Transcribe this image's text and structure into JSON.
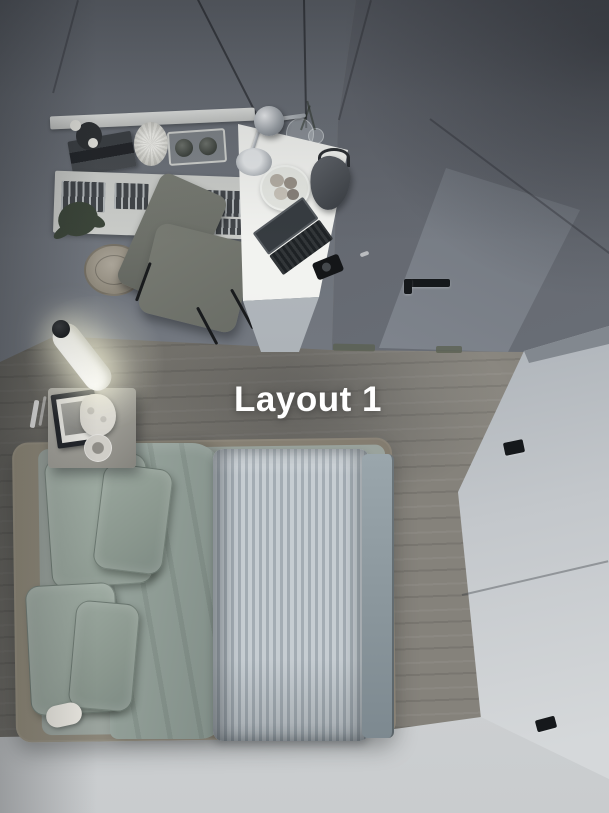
{
  "overlay": {
    "label": "Layout 1"
  },
  "colors": {
    "wall_left": "#70757d",
    "wall_right": "#62666e",
    "door": "#8d939c",
    "floor_wood": "#85827b",
    "floor_bottom": "#c6c9cc",
    "wardrobe_top": "#82888f",
    "wardrobe_front": "#aab0b6",
    "wardrobe_front_bottom": "#d5d8da",
    "bed_frame": "#8b8679",
    "pillow": "#97a49b",
    "duvet_sage": "#8e9b94",
    "duvet_stripe_light": "#c6cdd2",
    "duvet_stripe_dark": "#a3acb3",
    "bed_edge_band": "#8a969c",
    "desk": "#e9eae7",
    "chair": "#6f726b",
    "text": "#ffffff"
  }
}
